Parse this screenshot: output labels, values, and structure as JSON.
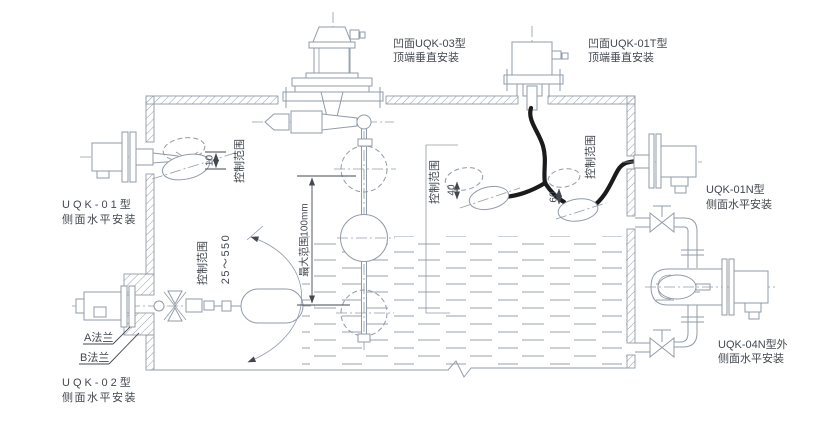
{
  "colors": {
    "line": "#919ba8",
    "text": "#43484f",
    "cable": "#1b1b1d",
    "background": "#ffffff"
  },
  "devices": {
    "uqk03": {
      "model": "凹面UQK-03型",
      "mount": "顶端垂直安装"
    },
    "uqk01t": {
      "model": "凹面UQK-01T型",
      "mount": "顶端垂直安装"
    },
    "uqk01": {
      "model": "UQK-01型",
      "mount": "侧面水平安装"
    },
    "uqk02": {
      "model": "UQK-02型",
      "mount": "侧面水平安装"
    },
    "uqk01n": {
      "model": "UQK-01N型",
      "mount": "侧面水平安装"
    },
    "uqk04n": {
      "model": "UQK-04N型外",
      "mount": "侧面水平安装"
    }
  },
  "annotations": {
    "control_range": "控制范围",
    "max_range": "最大范围100mm",
    "uqk02_travel_range": "25～550",
    "flange_a": "A法兰",
    "flange_b": "B法兰",
    "dim_uqk01": "10",
    "dim_pair_left": "40",
    "dim_pair_right": "60"
  }
}
